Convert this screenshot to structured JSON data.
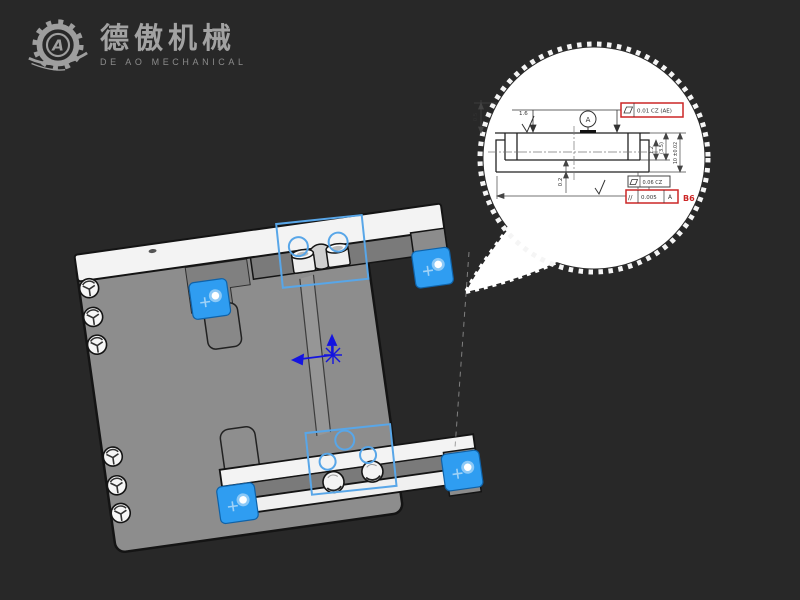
{
  "page": {
    "background": "#282828"
  },
  "logo": {
    "brand_cn": "德傲机械",
    "brand_en": "DE AO MECHANICAL",
    "monogram": "A",
    "color": "#9e9e9e"
  },
  "callout": {
    "drawing": {
      "datum_label": "A",
      "roughness_top": "1.6",
      "dim_left": "0.5",
      "dim_bottom": "0.2",
      "dim_right_1": "1.2",
      "dim_right_2": "(3.5)",
      "dim_right_3": "10 ±0.02",
      "gdt_top_value": "0.01 CZ (AE)",
      "gdt_mid_value": "0.06 CZ",
      "gdt_bottom_symbol": "//",
      "gdt_bottom_value": "0.005",
      "gdt_bottom_datum": "A",
      "balloon_tag": "B6"
    },
    "colors": {
      "highlight_red": "#cc2626",
      "paper": "#ffffff",
      "line": "#333333"
    }
  },
  "model": {
    "colors": {
      "plate_gray": "#8d8d8d",
      "rail_white": "#f3f3f3",
      "clamp_blue": "#2f9df1",
      "selection_blue": "#58a6e8",
      "origin_blue": "#1414e0",
      "outline": "#141414"
    }
  }
}
